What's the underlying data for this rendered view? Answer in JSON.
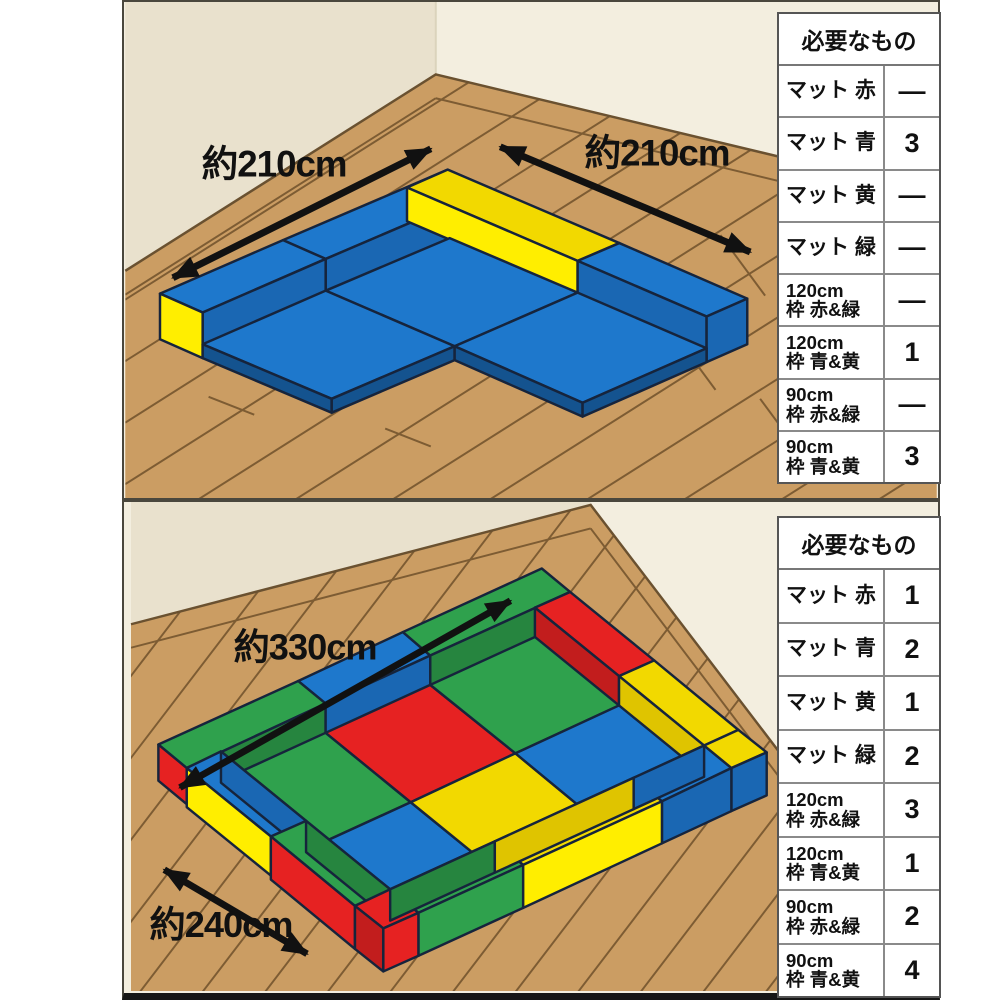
{
  "colors": {
    "wall_left": "#e9e1cd",
    "wall_right": "#f3eedf",
    "floor": "#cb9d63",
    "floor_line": "#7d5c33",
    "boundary": "#6a5130",
    "blue": "#1e78cc",
    "blue_side": "#1a67b3",
    "blue_dark": "#14538f",
    "yellow": "#f2d900",
    "yellow_bright": "#ffee00",
    "yellow_dark": "#dfc400",
    "green": "#2fa14d",
    "green_side": "#26853f",
    "red": "#e62222",
    "red_side": "#c21d1d",
    "arrow": "#111111",
    "text": "#111111"
  },
  "panels": [
    {
      "name": "corner-layout",
      "dims": {
        "left": "約210cm",
        "right": "約210cm"
      },
      "table": {
        "title": "必要なもの",
        "rows": [
          {
            "label": "マット 赤",
            "value": "—"
          },
          {
            "label": "マット 青",
            "value": "3"
          },
          {
            "label": "マット 黄",
            "value": "—"
          },
          {
            "label": "マット 緑",
            "value": "—"
          },
          {
            "label": "120cm\n枠 赤&緑",
            "value": "—"
          },
          {
            "label": "120cm\n枠 青&黄",
            "value": "1"
          },
          {
            "label": "90cm\n枠 赤&緑",
            "value": "—"
          },
          {
            "label": "90cm\n枠 青&黄",
            "value": "3"
          }
        ]
      }
    },
    {
      "name": "rectangle-layout",
      "dims": {
        "top": "約330cm",
        "left": "約240cm"
      },
      "table": {
        "title": "必要なもの",
        "rows": [
          {
            "label": "マット 赤",
            "value": "1"
          },
          {
            "label": "マット 青",
            "value": "2"
          },
          {
            "label": "マット 黄",
            "value": "1"
          },
          {
            "label": "マット 緑",
            "value": "2"
          },
          {
            "label": "120cm\n枠 赤&緑",
            "value": "3"
          },
          {
            "label": "120cm\n枠 青&黄",
            "value": "1"
          },
          {
            "label": "90cm\n枠 赤&緑",
            "value": "2"
          },
          {
            "label": "90cm\n枠 青&黄",
            "value": "4"
          }
        ]
      }
    }
  ]
}
